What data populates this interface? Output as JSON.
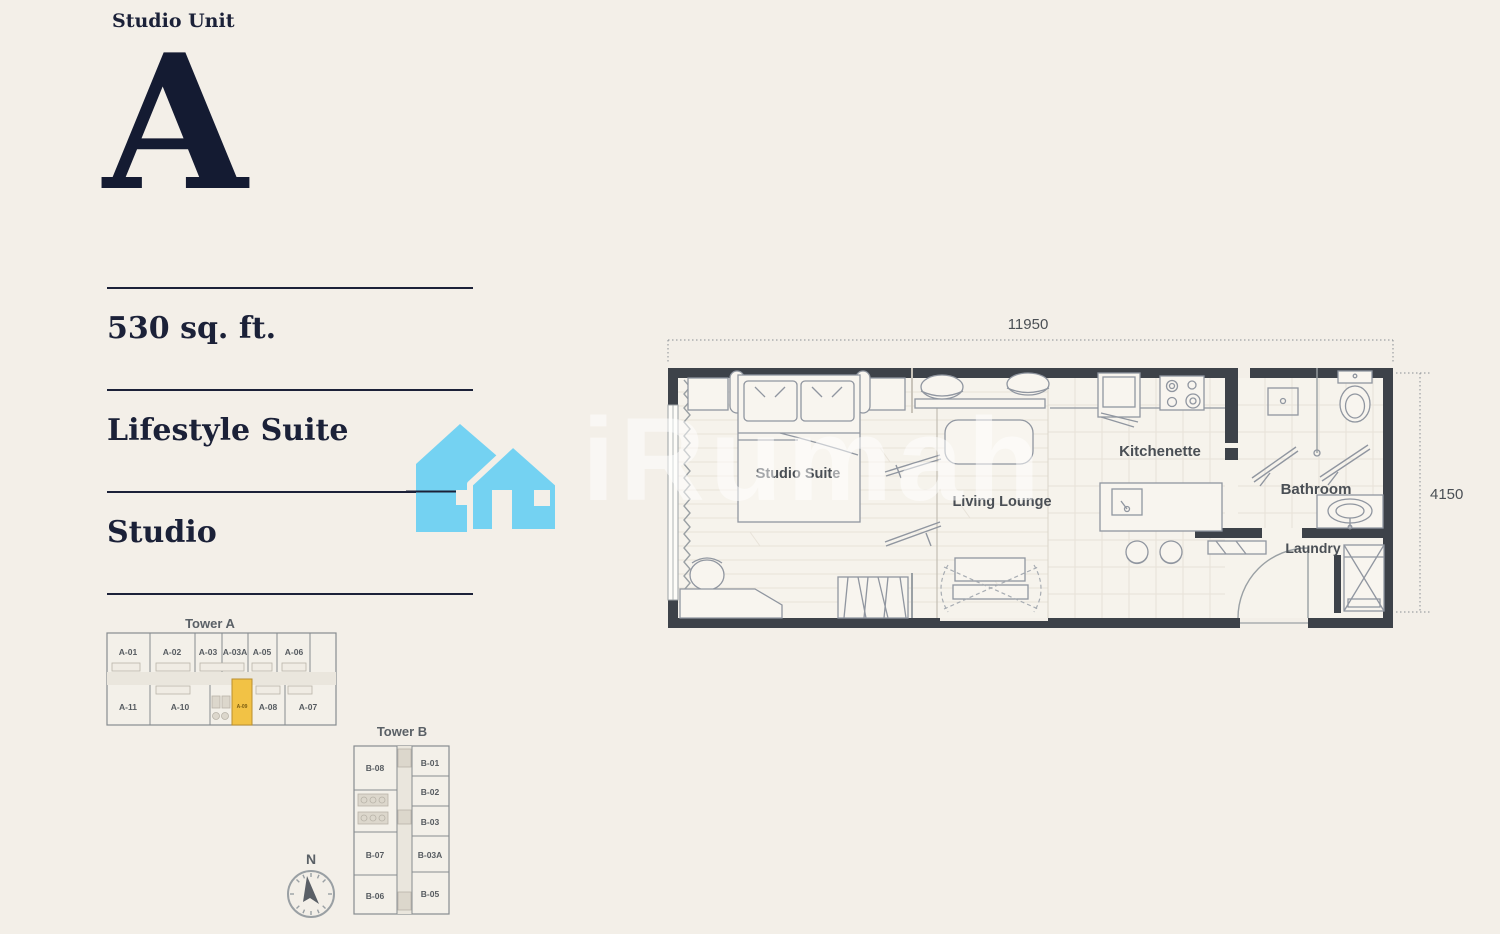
{
  "header": {
    "category": "Studio Unit",
    "unit_letter": "A"
  },
  "specs": {
    "area": "530 sq. ft.",
    "suite_type": "Lifestyle Suite",
    "layout": "Studio"
  },
  "floorplan": {
    "dim_width": "11950",
    "dim_height": "4150",
    "rooms": [
      "Studio Suite",
      "Living Lounge",
      "Kitchenette",
      "Bathroom",
      "Laundry"
    ]
  },
  "tower_a": {
    "title": "Tower A",
    "top_units": [
      "A-01",
      "A-02",
      "A-03",
      "A-03A",
      "A-05",
      "A-06"
    ],
    "bottom_units": [
      "A-11",
      "A-10",
      "A-08",
      "A-07"
    ],
    "highlight_unit": "A-09"
  },
  "tower_b": {
    "title": "Tower B",
    "left_units": [
      "B-08",
      "B-07",
      "B-06"
    ],
    "right_units": [
      "B-01",
      "B-02",
      "B-03",
      "B-03A",
      "B-05"
    ]
  },
  "compass": {
    "north_label": "N"
  },
  "watermark": {
    "text": "iRumah"
  },
  "colors": {
    "accent_navy": "#1b2138",
    "highlight_yellow": "#f2c245",
    "watermark_blue": "#74d2f2",
    "wall_dark": "#3d4249",
    "background": "#f3efe8"
  }
}
